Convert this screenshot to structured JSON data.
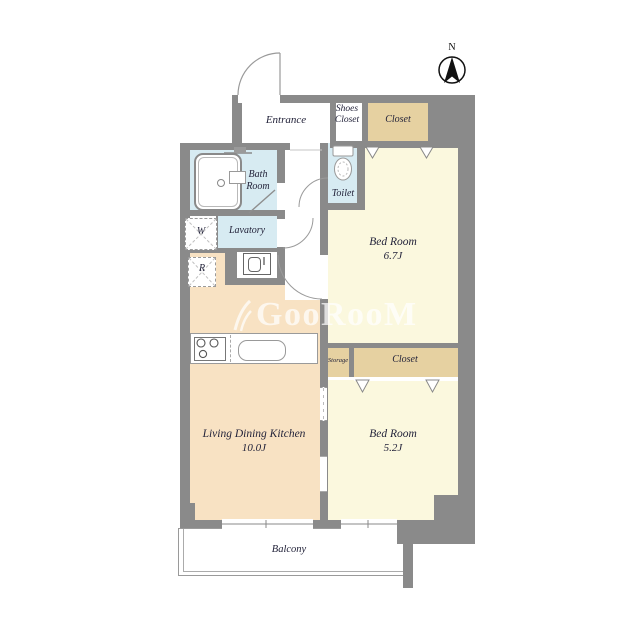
{
  "colors": {
    "wall": "#8a8a8a",
    "cream": "#fbf8de",
    "peach": "#f8e2c3",
    "tan": "#e6d1a1",
    "blue": "#d7ebf2",
    "ink": "#23233a",
    "wmcol": "rgba(255,255,255,0.72)"
  },
  "compass": {
    "label": "N"
  },
  "watermark": {
    "text": "GooRooM"
  },
  "rooms": {
    "entrance": {
      "label": "Entrance"
    },
    "shoes_closet": {
      "lines": [
        "Shoes",
        "Closet"
      ]
    },
    "closet_top": {
      "label": "Closet"
    },
    "bath": {
      "lines": [
        "Bath",
        "Room"
      ]
    },
    "toilet": {
      "label": "Toilet"
    },
    "lavatory": {
      "label": "Lavatory"
    },
    "washer": {
      "label": "W"
    },
    "refrigerator": {
      "label": "R"
    },
    "bedroom_1": {
      "lines": [
        "Bed Room",
        "6.7J"
      ]
    },
    "storage": {
      "label": "Storage"
    },
    "closet_2": {
      "label": "Closet"
    },
    "bedroom_2": {
      "lines": [
        "Bed Room",
        "5.2J"
      ]
    },
    "ldk": {
      "lines": [
        "Living Dining Kitchen",
        "10.0J"
      ]
    },
    "balcony": {
      "label": "Balcony"
    }
  },
  "icons": {
    "compass": "north-arrow-compass",
    "watermark_leaf": "leaf-logo",
    "bathtub": "bathtub",
    "shower": "shower-head",
    "toilet": "toilet-bowl",
    "washbasin": "washbasin",
    "stove": "stove-burners",
    "sink": "kitchen-sink",
    "washer_slot": "washing-machine-space",
    "fridge_slot": "refrigerator-space",
    "closet_doors": "hanging-door-marks"
  }
}
